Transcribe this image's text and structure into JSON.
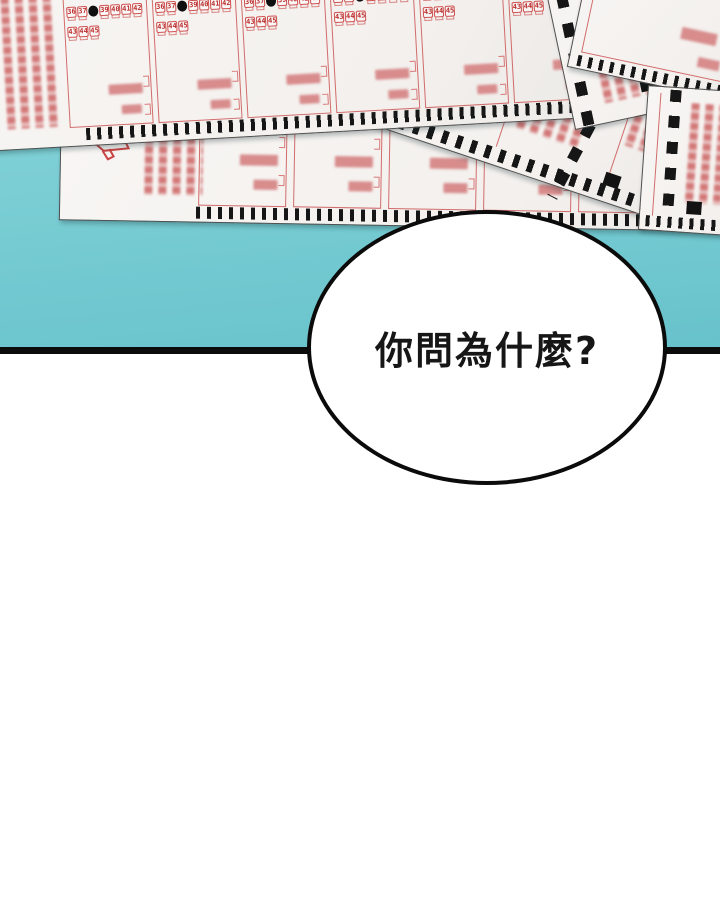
{
  "bubble": {
    "text": "你問為什麼?"
  },
  "lotto_slip": {
    "row1": [
      "36",
      "37",
      "38",
      "39",
      "40",
      "41",
      "42"
    ],
    "row1_marked_index": 2,
    "row2": [
      "43",
      "44",
      "45"
    ],
    "sections_top": 6,
    "sections_mid": 5
  },
  "colors": {
    "table_teal": "#7bced4",
    "ink_black": "#0c0c0c",
    "paper_white": "#f6f4f1",
    "slip_red": "#c94444"
  }
}
